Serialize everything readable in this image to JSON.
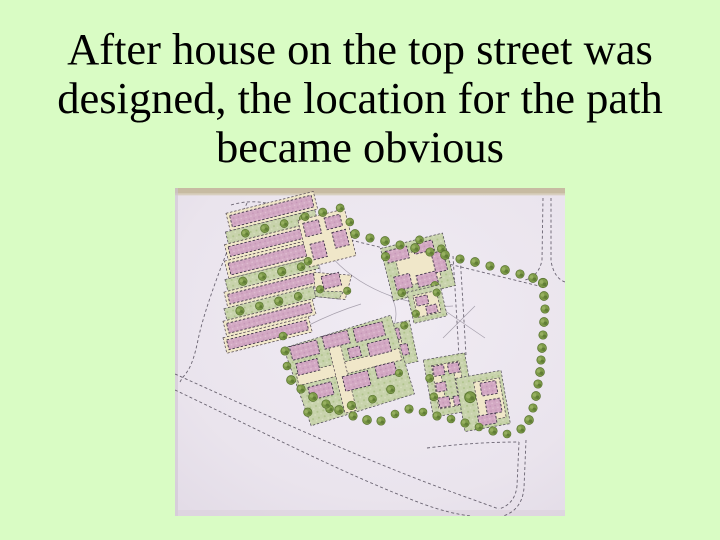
{
  "slide": {
    "title_lines": [
      "After house on the top street was",
      "designed, the location for the path",
      "became obvious"
    ],
    "title_text": "After house on the top street was designed, the location for the path became obvious"
  },
  "figure": {
    "name": "site-plan-photo",
    "description": "Photograph of a hand-drawn colored site plan: pink housing blocks with cream courtyards and green gardens, streets drawn as dashed lines, and rows of green trees lining the top street, the right-hand street and the lower boulevard",
    "palette": {
      "slide_background": "#d9fcc4",
      "title_color": "#000000",
      "paper": "#eae4ed",
      "photo_edge_tan": "#c7bba2",
      "building_pink": "#d3a9c3",
      "courtyard_cream": "#f0e7c9",
      "garden_green": "#c8d3ac",
      "tree_green": "#7e9b49",
      "road_line": "#4a4452"
    }
  }
}
